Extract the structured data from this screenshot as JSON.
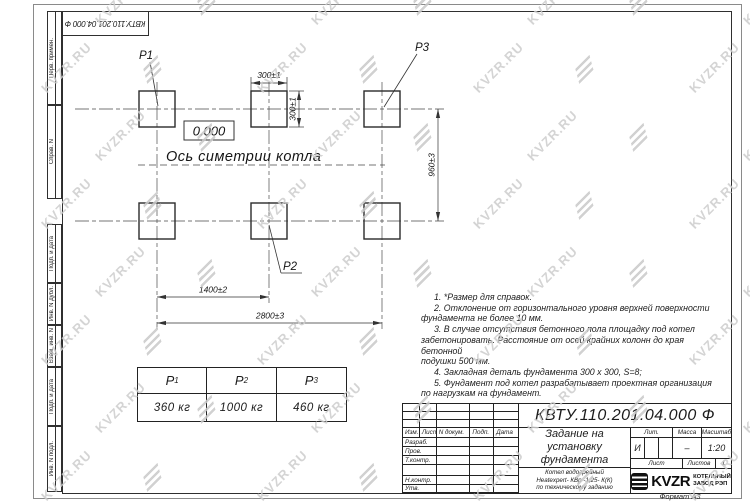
{
  "watermark": {
    "text": "KVZR.RU"
  },
  "page": {
    "format_label": "Формат А3"
  },
  "top_stamp": {
    "designation": "КВТУ.110.201.04.000  Ф"
  },
  "margin_labels": [
    "Перв. примен.",
    "Справ. N",
    "Подп. и дата",
    "Инв. N дубл.",
    "Взам. инв. N",
    "Подп. и дата",
    "Инв. N подл."
  ],
  "drawing": {
    "point_labels": {
      "p1": "P1",
      "p2": "P2",
      "p3": "P3"
    },
    "elevation": "0.000",
    "axis_label": "Ось симетрии котла",
    "dimensions": {
      "pad_width": "300±1",
      "pad_height": "300±1",
      "row_spacing": "960±3",
      "mid_span": "1400±2",
      "full_span": "2800±3"
    }
  },
  "load_table": {
    "columns": [
      {
        "symbol": "P",
        "sub": "1",
        "value": "360 кг"
      },
      {
        "symbol": "P",
        "sub": "2",
        "value": "1000 кг"
      },
      {
        "symbol": "P",
        "sub": "3",
        "value": "460 кг"
      }
    ]
  },
  "notes": [
    "1. *Размер для справок.",
    "2. Отклонение от горизонтального уровня верхней поверхности\nфундамента не более 10 мм.",
    "3. В случае отсутствия бетонного пола площадку под котел\nзабетонировать. Расстояние от осей крайних колонн до края бетонной\nподушки 500 мм.",
    "4. Закладная деталь фундамента  300 x 300, S=8;",
    "5. Фундамент под котел разрабатывает проектная организация\nпо нагрузкам на фундамент."
  ],
  "title_block": {
    "designation": "КВТУ.110.201.04.000  Ф",
    "title": "Задание на\nустановку\nфундамента",
    "subtitle": "Котел водогрейный\nHeatexpert- КВр -1,25- К(К)\nпо техническому заданию",
    "header_row": [
      "Изм.",
      "Лист",
      "N докум.",
      "Подп.",
      "Дата"
    ],
    "sign_rows": [
      "Разраб.",
      "Пров.",
      "Т.контр.",
      "",
      "Н.контр.",
      "Утв."
    ],
    "lit_label": "Лит.",
    "lit_value": "И",
    "mass_label": "Масса",
    "mass_value": "–",
    "scale_label": "Масштаб",
    "scale_value": "1:20",
    "sheet_label": "Лист",
    "sheets_label": "Листов",
    "sheets_value": "1",
    "company": {
      "logo_text": "KVZR",
      "name": "КОТЕЛЬНЫЙ\nЗАВОД РЭП"
    }
  }
}
